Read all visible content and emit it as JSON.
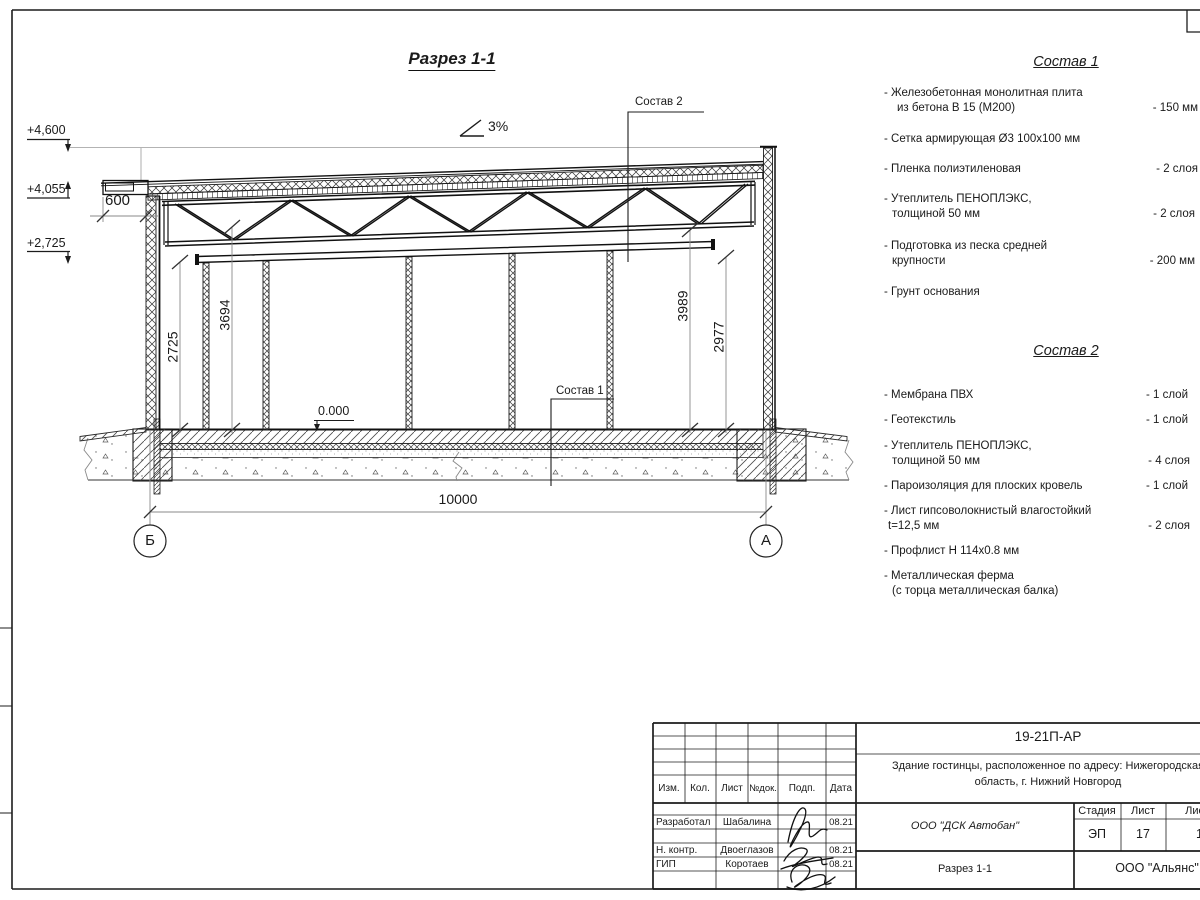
{
  "drawing": {
    "title": "Разрез 1-1",
    "slope": "3%",
    "leader1": "Состав 1",
    "leader2": "Состав 2",
    "elevations": [
      "+4,600",
      "+4,055",
      "+2,725"
    ],
    "dims": {
      "d600": "600",
      "d2725": "2725",
      "d3694": "3694",
      "d3989": "3989",
      "d2977": "2977",
      "d10000": "10000",
      "level0": "0.000"
    },
    "axes": {
      "left": "Б",
      "right": "А"
    }
  },
  "s1": {
    "title": "Состав 1",
    "items": [
      {
        "l1": "- Железобетонная  монолитная плита",
        "l2": "из бетона В 15 (М200)",
        "val": "- 150 мм"
      },
      {
        "l1": "- Сетка армирующая Ø3 100х100 мм",
        "l2": "",
        "val": ""
      },
      {
        "l1": "- Пленка полиэтиленовая",
        "l2": "",
        "val": "- 2 слоя"
      },
      {
        "l1": "- Утеплитель ПЕНОПЛЭКС,",
        "l2": "толщиной 50 мм",
        "val": "- 2 слоя"
      },
      {
        "l1": "- Подготовка из песка средней",
        "l2": "крупности",
        "val": "- 200 мм"
      },
      {
        "l1": "- Грунт основания",
        "l2": "",
        "val": ""
      }
    ]
  },
  "s2": {
    "title": "Состав 2",
    "items": [
      {
        "l1": "- Мембрана ПВХ",
        "l2": "",
        "val": "- 1 слой"
      },
      {
        "l1": "- Геотекстиль",
        "l2": "",
        "val": "- 1 слой"
      },
      {
        "l1": "- Утеплитель ПЕНОПЛЭКС,",
        "l2": "толщиной 50 мм",
        "val": "- 4 слоя"
      },
      {
        "l1": "- Пароизоляция для плоских кровель",
        "l2": "",
        "val": "- 1 слой"
      },
      {
        "l1": "- Лист гипсоволокнистый влагостойкий",
        "l2": "t=12,5 мм",
        "val": "- 2 слоя"
      },
      {
        "l1": "- Профлист Н 114х0.8 мм",
        "l2": "",
        "val": ""
      },
      {
        "l1": "- Металлическая ферма",
        "l2": "(с торца металлическая балка)",
        "val": ""
      }
    ]
  },
  "tb": {
    "doc_code": "19-21П-АР",
    "project_l1": "Здание гостинцы, расположенное по адресу: Нижегородская",
    "project_l2": "область, г. Нижний Новгород",
    "cols": [
      "Изм.",
      "Кол.",
      "Лист",
      "№док.",
      "Подп.",
      "Дата"
    ],
    "rows": [
      {
        "role": "Разработал",
        "name": "Шабалина",
        "date": "08.21"
      },
      {
        "role": "Н. контр.",
        "name": "Двоеглазов",
        "date": "08.21"
      },
      {
        "role": "ГИП",
        "name": "Коротаев",
        "date": "08.21"
      }
    ],
    "org": "ООО \"ДСК Автобан\"",
    "stage_label": "Стадия",
    "sheet_label": "Лист",
    "sheets_label": "Листов",
    "stage": "ЭП",
    "sheet": "17",
    "sheets": "18",
    "sheet_title": "Разрез 1-1",
    "company": "ООО \"Альянс\""
  }
}
